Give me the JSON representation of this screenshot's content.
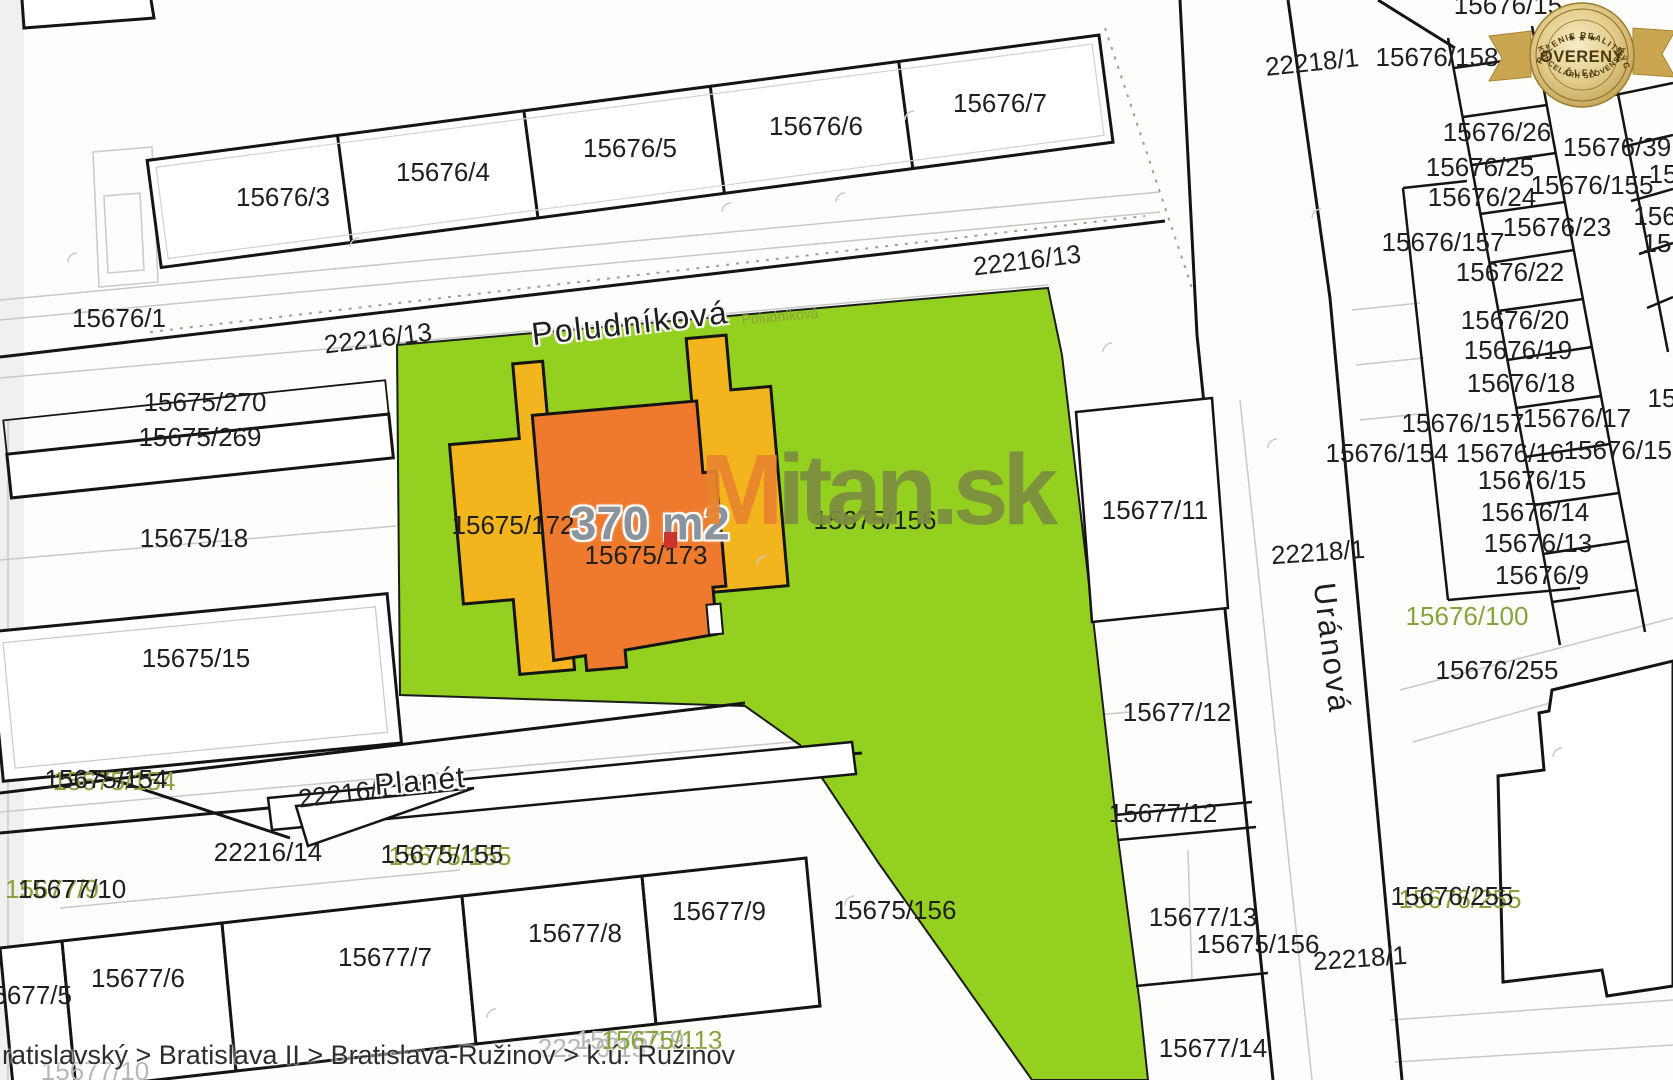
{
  "title": "Cadastral map - k.ú. Ružinov",
  "colors": {
    "ink": "#1f1f1f",
    "olive": "#87a33b",
    "lightgray": "#b5b9b3",
    "gray": "#8b949c",
    "green": "#94d020",
    "yellow": "#f3b51e",
    "orange": "#ef7a2e",
    "line_black": "#141414",
    "line_gray": "#c9c9c6",
    "wm_orange": "#e8842d",
    "wm_olive": "#7d8d3f",
    "badge_gold": "#cfa952",
    "badge_text": "#4c3a10"
  },
  "area_highlight": {
    "area_label": "370 m2",
    "parcel": "15675/173"
  },
  "watermark": {
    "m": "M",
    "rest": "itan.sk"
  },
  "breadcrumb": {
    "path": "ratislavský > Bratislava II > Bratislava-Ružinov > k.ú. Ružinov"
  },
  "badge": {
    "top_arc": "ZDRUŽENIE REALITNÝCH",
    "stars": "★ ★ ★",
    "main": "OVERENÝ",
    "sub": "ČLEN",
    "bottom_arc": "KANCELÁRIÍ SLOVENSKA"
  },
  "map_labels": [
    {
      "text": "15676/3",
      "x": 283,
      "y": 197
    },
    {
      "text": "15676/4",
      "x": 443,
      "y": 172
    },
    {
      "text": "15676/5",
      "x": 630,
      "y": 148
    },
    {
      "text": "15676/6",
      "x": 816,
      "y": 126
    },
    {
      "text": "15676/7",
      "x": 1000,
      "y": 103
    },
    {
      "text": "15676/1",
      "x": 119,
      "y": 318
    },
    {
      "text": "22216/13",
      "x": 378,
      "y": 338,
      "rot": -7
    },
    {
      "text": "Poludníková",
      "x": 630,
      "y": 323,
      "rot": -6.5,
      "size": 32,
      "spacing": 2,
      "halo": true,
      "name": "street-label-poludnikova"
    },
    {
      "text": "Poludníková",
      "x": 780,
      "y": 316,
      "rot": -5,
      "size": 14,
      "color": "olive",
      "name": "street-label-poludnikova-small"
    },
    {
      "text": "22216/13",
      "x": 1027,
      "y": 260,
      "rot": -7
    },
    {
      "text": "22218/1",
      "x": 1312,
      "y": 62,
      "rot": -6
    },
    {
      "text": "15676/158",
      "x": 1437,
      "y": 57
    },
    {
      "text": "15676/15",
      "x": 1508,
      "y": 5
    },
    {
      "text": "15676/26",
      "x": 1497,
      "y": 132
    },
    {
      "text": "15676/25",
      "x": 1480,
      "y": 167
    },
    {
      "text": "15676/24",
      "x": 1482,
      "y": 197
    },
    {
      "text": "15676/23",
      "x": 1557,
      "y": 227
    },
    {
      "text": "15676/155",
      "x": 1592,
      "y": 185
    },
    {
      "text": "15676/39",
      "x": 1617,
      "y": 147
    },
    {
      "text": "15676/157",
      "x": 1443,
      "y": 242
    },
    {
      "text": "15676/22",
      "x": 1510,
      "y": 272
    },
    {
      "text": "15676/20",
      "x": 1515,
      "y": 320
    },
    {
      "text": "15676/19",
      "x": 1518,
      "y": 350
    },
    {
      "text": "15676/18",
      "x": 1521,
      "y": 383
    },
    {
      "text": "15676/157",
      "x": 1463,
      "y": 423
    },
    {
      "text": "15676/17",
      "x": 1577,
      "y": 418
    },
    {
      "text": "15676/154",
      "x": 1387,
      "y": 453
    },
    {
      "text": "15676/16",
      "x": 1510,
      "y": 453
    },
    {
      "text": "15676/155",
      "x": 1625,
      "y": 450
    },
    {
      "text": "15676/15",
      "x": 1532,
      "y": 480
    },
    {
      "text": "15676/14",
      "x": 1535,
      "y": 512
    },
    {
      "text": "15676/13",
      "x": 1538,
      "y": 543
    },
    {
      "text": "15676/9",
      "x": 1542,
      "y": 575
    },
    {
      "text": "15676/100",
      "x": 1467,
      "y": 616,
      "color": "olive"
    },
    {
      "text": "15676/255",
      "x": 1497,
      "y": 670
    },
    {
      "text": "15676/255",
      "x": 1460,
      "y": 899,
      "color": "olive"
    },
    {
      "text": "15676/255",
      "x": 1452,
      "y": 896
    },
    {
      "text": "22218/1",
      "x": 1318,
      "y": 552,
      "rot": -4
    },
    {
      "text": "Uránová",
      "x": 1332,
      "y": 648,
      "rot": 83,
      "size": 31,
      "spacing": 2,
      "halo": true,
      "name": "street-label-uranova"
    },
    {
      "text": "22218/1",
      "x": 1360,
      "y": 958,
      "rot": -4
    },
    {
      "text": "15",
      "x": 1663,
      "y": 174
    },
    {
      "text": "156",
      "x": 1655,
      "y": 216
    },
    {
      "text": "15",
      "x": 1657,
      "y": 243
    },
    {
      "text": "15",
      "x": 1662,
      "y": 398
    },
    {
      "text": "15675/172",
      "x": 513,
      "y": 525
    },
    {
      "text": "370 m2",
      "x": 650,
      "y": 523,
      "size": 47,
      "bold": true,
      "color": "gray",
      "halo": true,
      "name": "area-measurement-label"
    },
    {
      "text": "15675/173",
      "x": 646,
      "y": 555,
      "name": "subject-parcel-label"
    },
    {
      "text": "15675/156",
      "x": 875,
      "y": 520
    },
    {
      "text": "15675/156",
      "x": 895,
      "y": 910
    },
    {
      "text": "15675/156",
      "x": 1258,
      "y": 944
    },
    {
      "text": "15677/11",
      "x": 1155,
      "y": 510
    },
    {
      "text": "15677/12",
      "x": 1177,
      "y": 712
    },
    {
      "text": "15677/12",
      "x": 1163,
      "y": 813
    },
    {
      "text": "15677/13",
      "x": 1203,
      "y": 917
    },
    {
      "text": "15677/14",
      "x": 1213,
      "y": 1048
    },
    {
      "text": "15675/270",
      "x": 205,
      "y": 402
    },
    {
      "text": "15675/269",
      "x": 200,
      "y": 437
    },
    {
      "text": "15675/18",
      "x": 194,
      "y": 538
    },
    {
      "text": "15675/15",
      "x": 196,
      "y": 658
    },
    {
      "text": "15675/154",
      "x": 114,
      "y": 781,
      "color": "olive"
    },
    {
      "text": "15675/154",
      "x": 106,
      "y": 779
    },
    {
      "text": "22216/1",
      "x": 345,
      "y": 793,
      "rot": -7
    },
    {
      "text": "Planét",
      "x": 420,
      "y": 782,
      "rot": -5,
      "size": 30,
      "spacing": 1,
      "halo": true,
      "name": "street-label-planet"
    },
    {
      "text": "22216/14",
      "x": 268,
      "y": 852
    },
    {
      "text": "15675/155",
      "x": 450,
      "y": 856,
      "color": "olive"
    },
    {
      "text": "15675/155",
      "x": 442,
      "y": 854
    },
    {
      "text": "15677/9",
      "x": 52,
      "y": 889,
      "color": "olive"
    },
    {
      "text": "15677/10",
      "x": 72,
      "y": 889
    },
    {
      "text": "15677/6",
      "x": 138,
      "y": 978
    },
    {
      "text": "15677/5",
      "x": 25,
      "y": 995
    },
    {
      "text": "15677/7",
      "x": 385,
      "y": 957
    },
    {
      "text": "15677/8",
      "x": 575,
      "y": 933
    },
    {
      "text": "15677/9",
      "x": 719,
      "y": 911
    },
    {
      "text": "22216/15",
      "x": 592,
      "y": 1048,
      "color": "lightgray"
    },
    {
      "text": "15675/19",
      "x": 630,
      "y": 1040,
      "color": "lightgray"
    },
    {
      "text": "15675/113",
      "x": 662,
      "y": 1040,
      "color": "olive"
    },
    {
      "text": "15677/10",
      "x": 95,
      "y": 1071,
      "color": "lightgray"
    }
  ]
}
